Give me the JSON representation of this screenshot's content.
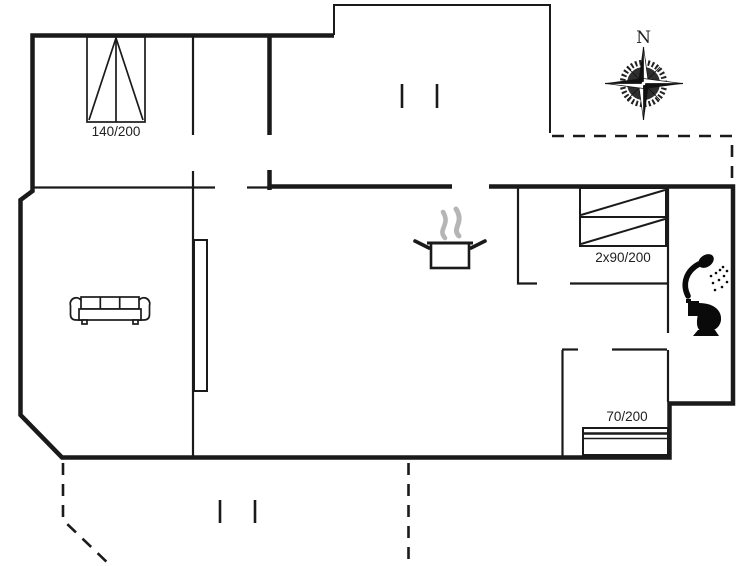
{
  "document": {
    "type": "holiday-home-floor-plan",
    "orientation_label": "N"
  },
  "colors": {
    "line": "#1a1a1a",
    "steam_gray": "#b5b5b5",
    "background": "#ffffff"
  },
  "furnishings": {
    "double_bed": {
      "label": "140/200",
      "icon": "double-bed-icon"
    },
    "bunk_bed": {
      "label": "2x90/200",
      "icon": "bunk-bed-icon"
    },
    "single_bed": {
      "label": "70/200",
      "icon": "single-bed-icon"
    },
    "sofa": {
      "icon": "sofa-icon"
    },
    "stove": {
      "icon": "cooking-pot-steam-icon"
    },
    "shower": {
      "icon": "shower-icon"
    },
    "toilet": {
      "icon": "toilet-icon"
    },
    "cabinet": {
      "icon": "built-in-cabinet"
    }
  },
  "compass": {
    "north_label": "N",
    "icon": "compass-rose-icon"
  }
}
